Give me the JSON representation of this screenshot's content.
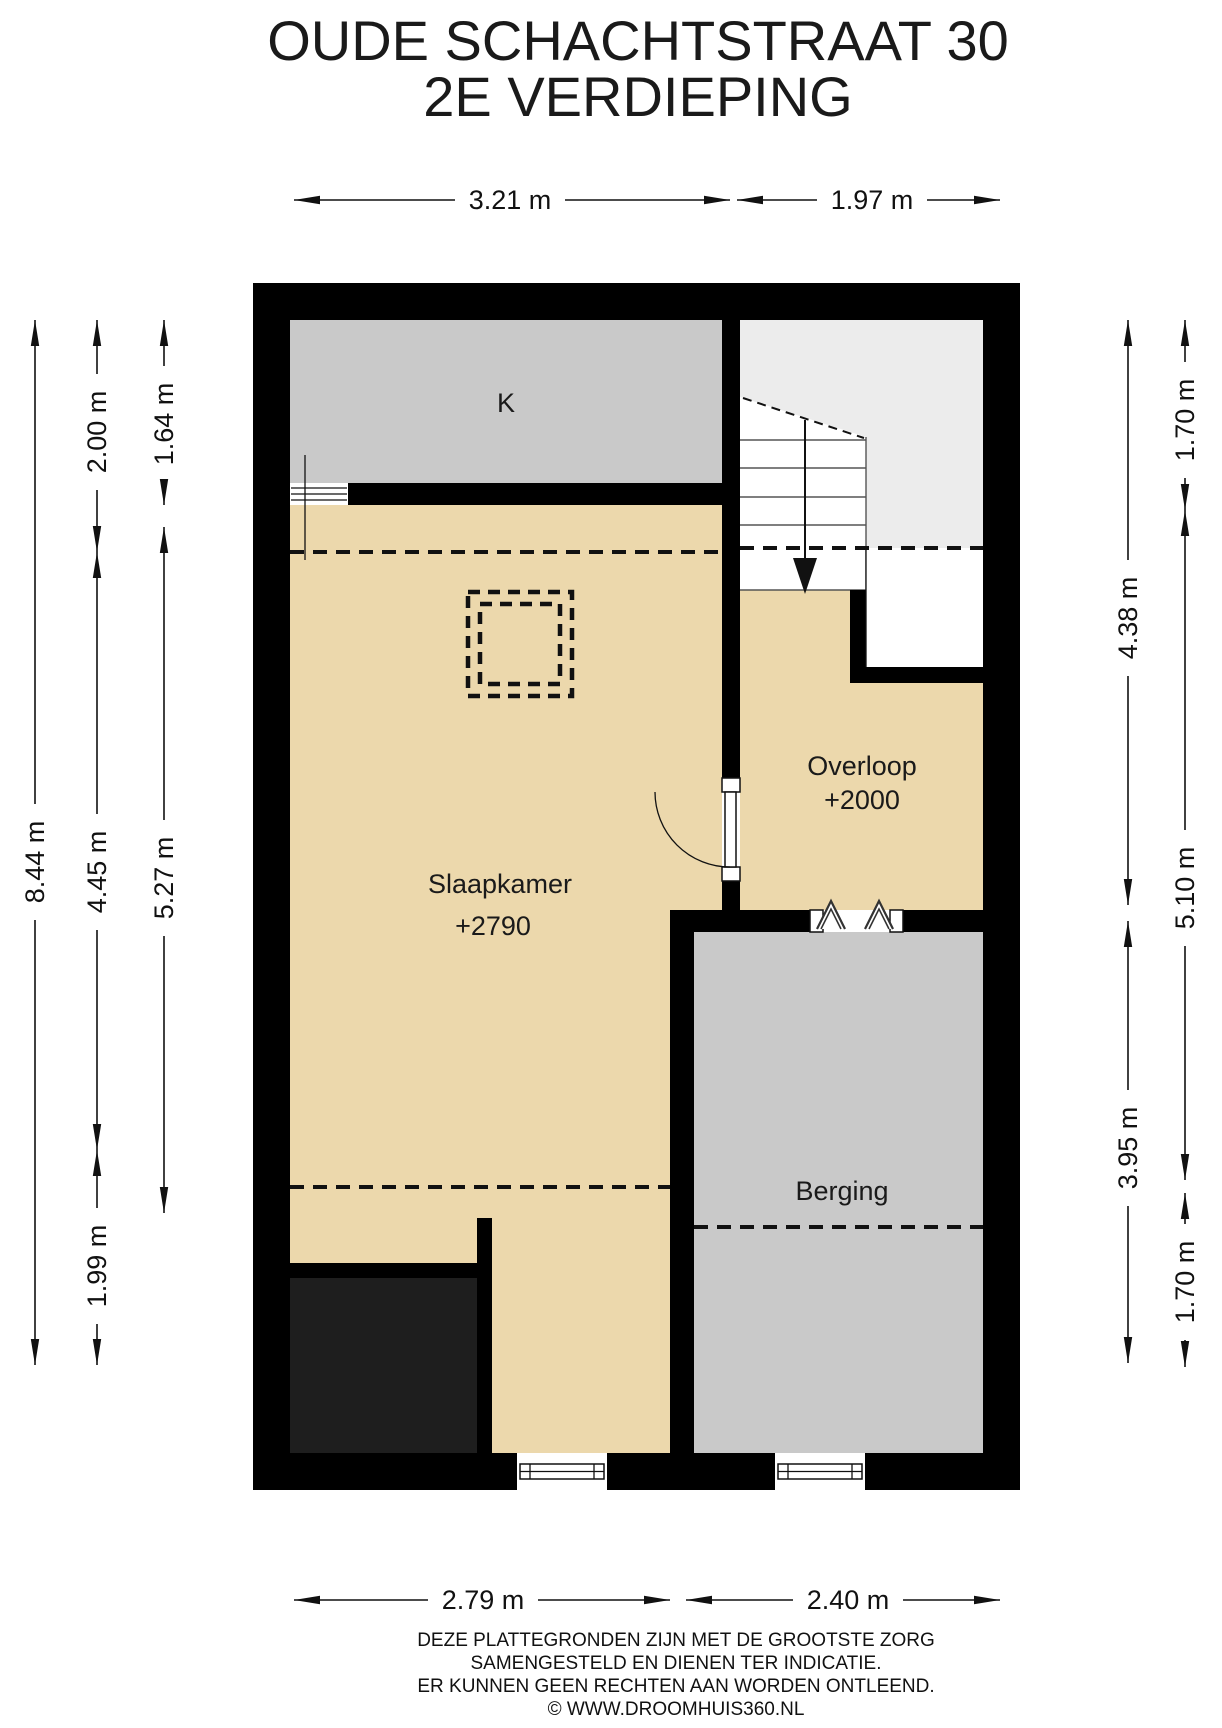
{
  "title": {
    "line1": "OUDE SCHACHTSTRAAT 30",
    "line2": "2E VERDIEPING"
  },
  "rooms": {
    "k": {
      "label": "K"
    },
    "slaapkamer": {
      "label": "Slaapkamer",
      "ceiling_height": "+2790"
    },
    "overloop": {
      "label": "Overloop",
      "ceiling_height": "+2000"
    },
    "berging": {
      "label": "Berging"
    }
  },
  "dimensions": {
    "top": [
      {
        "label": "3.21 m"
      },
      {
        "label": "1.97 m"
      }
    ],
    "bottom": [
      {
        "label": "2.79 m"
      },
      {
        "label": "2.40 m"
      }
    ],
    "left": [
      {
        "label": "8.44 m"
      },
      {
        "label": "2.00 m"
      },
      {
        "label": "1.64 m"
      },
      {
        "label": "4.45 m"
      },
      {
        "label": "5.27 m"
      },
      {
        "label": "1.99 m"
      }
    ],
    "right": [
      {
        "label": "1.70 m"
      },
      {
        "label": "4.38 m"
      },
      {
        "label": "5.10 m"
      },
      {
        "label": "3.95 m"
      },
      {
        "label": "1.70 m"
      }
    ]
  },
  "icons": {
    "stairs_direction": "down-arrow",
    "door": "swing-door-arc",
    "berging_opening": "double-chevron",
    "window": "double-line-window"
  },
  "footer": {
    "line1": "DEZE PLATTEGRONDEN ZIJN MET DE GROOTSTE ZORG",
    "line2": "SAMENGESTELD EN DIENEN TER INDICATIE.",
    "line3": "ER KUNNEN GEEN RECHTEN AAN WORDEN ONTLEEND.",
    "line4": "© WWW.DROOMHUIS360.NL"
  },
  "colors": {
    "wall": "#000000",
    "floor_tan": "#ecd8ac",
    "room_gray": "#c9c9c9",
    "stair_gray": "#ececec",
    "void_dark": "#1e1e1e",
    "background": "#ffffff"
  }
}
